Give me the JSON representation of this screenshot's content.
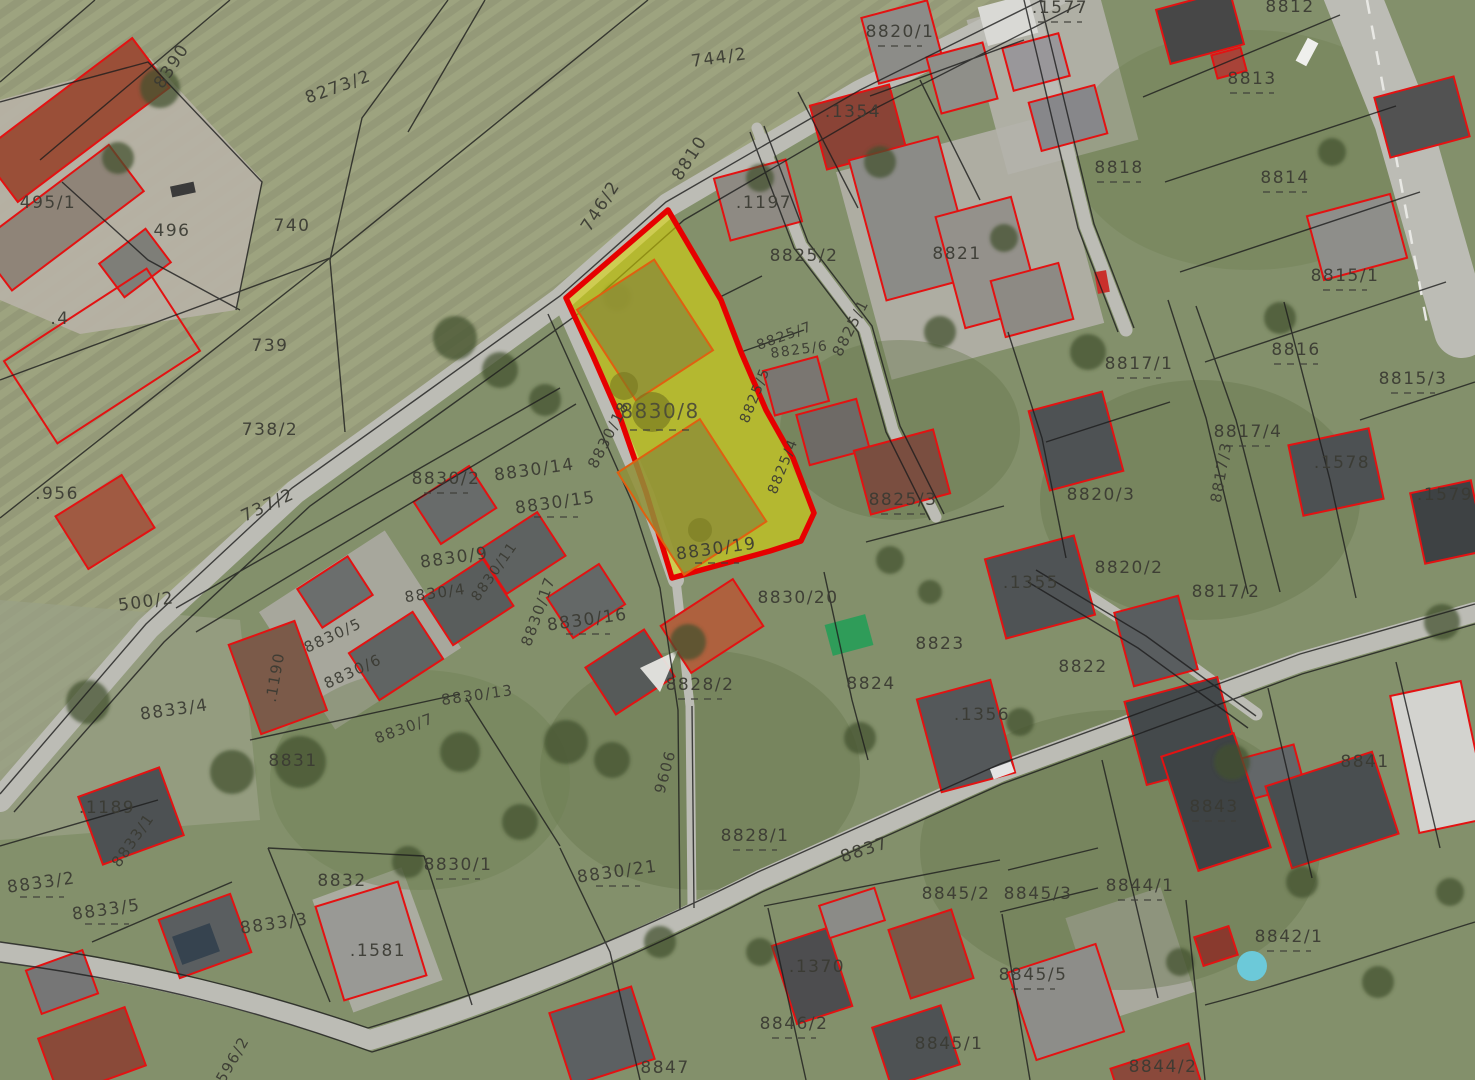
{
  "map": {
    "type": "cadastral-orthophoto",
    "highlight": {
      "parcel": "8830/8",
      "fill": "#dcd800",
      "border": "#e60000"
    },
    "colors": {
      "parcel_line": "#1d1d1d",
      "building_outline": "#e31212",
      "label": "#3b3b33",
      "field": "#959a7c",
      "road": "#bcbcb5"
    },
    "labels": [
      "8390",
      "8273/2",
      "744/2",
      "495/1",
      "496",
      "740",
      "746/2",
      "8810",
      ".1197",
      ".1354",
      "8820/1",
      "8825/2",
      "8821",
      ".1577",
      "8812",
      "8813",
      "8818",
      "8814",
      "8815/1",
      ".4",
      "739",
      "738/2",
      ".956",
      "737/2",
      "8830/2",
      "8830/14",
      "8830/15",
      "8830/8",
      "8830/18",
      "8825/7",
      "8825/6",
      "8825/1",
      "8825/5",
      "8825/4",
      "8825/3",
      "8816",
      "8817/1",
      "8815/3",
      "8817/4",
      "8817/3",
      ".1578",
      "8820/3",
      ".1579",
      "8820/2",
      "8817/2",
      ".1355",
      "500/2",
      "8830/9",
      "8830/11",
      "8830/4",
      "8830/17",
      "8830/16",
      "8830/19",
      "8830/20",
      "8830/5",
      "8830/6",
      "8830/13",
      "8830/7",
      ".1190",
      "8831",
      "8833/4",
      ".1189",
      "8833/1",
      "8828/2",
      "8823",
      "8824",
      ".1356",
      "9606",
      "8822",
      "8841",
      "8843",
      "8828/1",
      "8837",
      "8830/21",
      "8830/1",
      "8833/2",
      "8833/5",
      "8833/3",
      "8832",
      ".1581",
      "8844/1",
      "8845/3",
      "8845/2",
      "8842/1",
      "8845/5",
      ".1370",
      "8846/2",
      "8845/1",
      "8847",
      "8844/2",
      "596/2"
    ]
  }
}
